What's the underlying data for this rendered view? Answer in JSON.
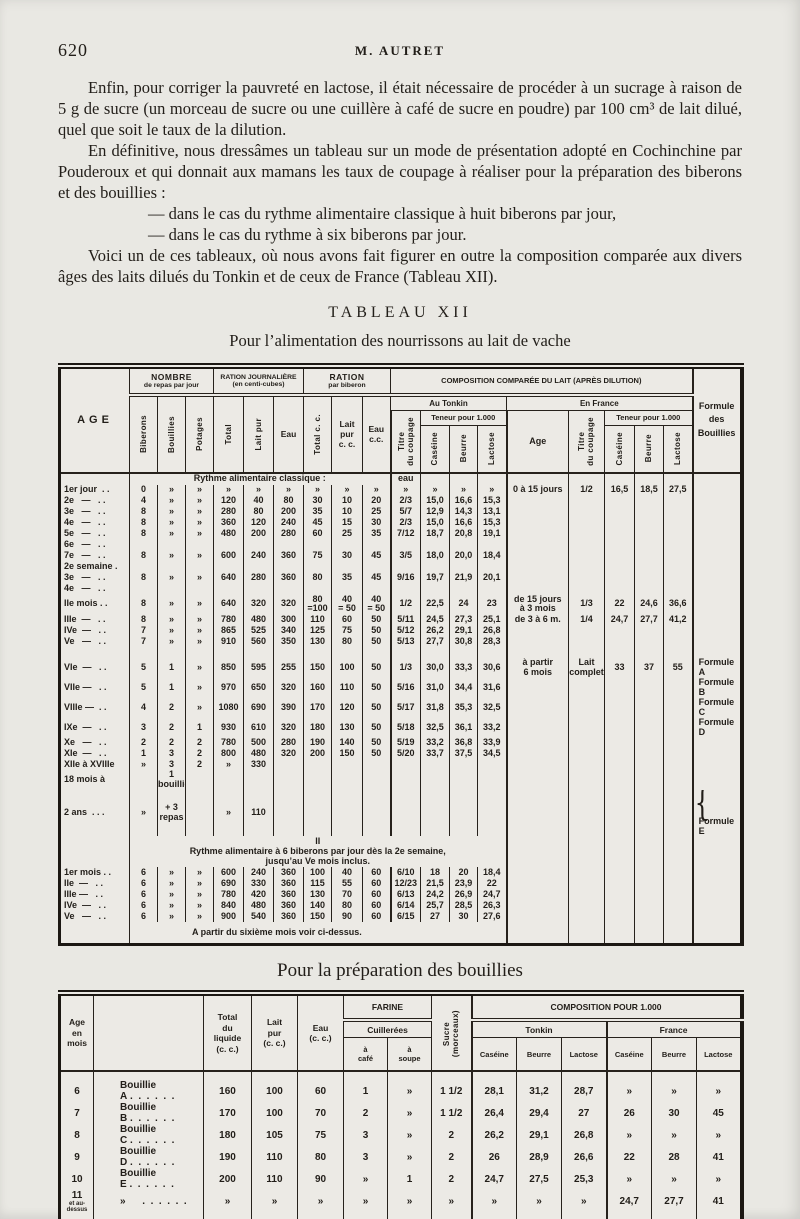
{
  "page": {
    "number": "620",
    "running_title": "M. AUTRET",
    "para1": "Enfin, pour corriger la pauvreté en lactose, il était nécessaire de procéder à un sucrage à raison de 5 g de sucre (un morceau de sucre ou une cuillère à café de sucre en poudre) par 100 cm³ de lait dilué, quel que soit le taux de la dilution.",
    "para2": "En définitive, nous dressâmes un tableau sur un mode de présentation adopté en Cochinchine par Pouderoux et qui donnait aux mamans les taux de coupage à réaliser pour la préparation des biberons et des bouillies :",
    "bullet1": "— dans le cas du rythme alimentaire classique à huit biberons par jour,",
    "bullet2": "— dans le cas du rythme à six biberons par jour.",
    "para3": "Voici un de ces tableaux, où nous avons fait figurer en outre la composition comparée aux divers âges des laits dilués du Tonkin et de ceux de France (Tableau XII).",
    "table1_title": "TABLEAU XII",
    "table1_subtitle": "Pour l’alimentation des nourrissons au lait de vache",
    "table2_title": "Pour la préparation des bouillies"
  },
  "table1": {
    "header": {
      "age": "AGE",
      "nombre": "NOMBRE",
      "nombre_sub": "de repas par jour",
      "ration_j": "RATION JOURNALIÈRE",
      "ration_j_sub": "(en centi-cubes)",
      "ration_b": "RATION",
      "ration_b_sub": "par biberon",
      "composition": "COMPOSITION COMPARÉE DU LAIT (APRÈS DILUTION)",
      "tonkin": "Au Tonkin",
      "france": "En France",
      "teneur": "Teneur pour 1.000",
      "formule": "Formule\ndes\nBouillies",
      "cols": {
        "biberons": "Biberons",
        "bouillies": "Bouillies",
        "potages": "Potages",
        "total": "Total",
        "lait_pur": "Lait pur",
        "eau": "Eau",
        "total_cc": "Total c. c.",
        "lait_cc": "Lait\npur\nc. c.",
        "eau_cc": "Eau\nc.c.",
        "titre": "Titre\ndu coupage",
        "caseine": "Caséine",
        "beurre": "Beurre",
        "lactose": "Lactose",
        "age_fr": "Age"
      }
    },
    "brace_glyph": "{",
    "section1": {
      "heading": "Rythme alimentaire classique :",
      "eau_note": "eau",
      "rows": [
        {
          "age": "1er jour  . .",
          "c": [
            "0",
            "»",
            "»",
            "»",
            "»",
            "»",
            "»",
            "»",
            "»",
            "»",
            "»",
            "»",
            "»"
          ],
          "fr": [
            "0 à 15 jours",
            "1/2",
            "16,5",
            "18,5",
            "27,5"
          ]
        },
        {
          "age": "2e   —   . .",
          "c": [
            "4",
            "»",
            "»",
            "120",
            "40",
            "80",
            "30",
            "10",
            "20",
            "2/3",
            "15,0",
            "16,6",
            "15,3"
          ]
        },
        {
          "age": "3e   —   . .",
          "c": [
            "8",
            "»",
            "»",
            "280",
            "80",
            "200",
            "35",
            "10",
            "25",
            "5/7",
            "12,9",
            "14,3",
            "13,1"
          ]
        },
        {
          "age": "4e   —   . .",
          "c": [
            "8",
            "»",
            "»",
            "360",
            "120",
            "240",
            "45",
            "15",
            "30",
            "2/3",
            "15,0",
            "16,6",
            "15,3"
          ]
        },
        {
          "age": "5e   —   . .",
          "c": [
            "8",
            "»",
            "»",
            "480",
            "200",
            "280",
            "60",
            "25",
            "35",
            "7/12",
            "18,7",
            "20,8",
            "19,1"
          ]
        },
        {
          "age": "6e   —   . ."
        },
        {
          "age": "7e   —   . .",
          "c": [
            "8",
            "»",
            "»",
            "600",
            "240",
            "360",
            "75",
            "30",
            "45",
            "3/5",
            "18,0",
            "20,0",
            "18,4"
          ]
        },
        {
          "age": "2e semaine ."
        },
        {
          "age": "3e   —   . .",
          "c": [
            "8",
            "»",
            "»",
            "640",
            "280",
            "360",
            "80",
            "35",
            "45",
            "9/16",
            "19,7",
            "21,9",
            "20,1"
          ]
        },
        {
          "age": "4e   —   . ."
        },
        {
          "age": "IIe mois . .",
          "c": [
            "8",
            "»",
            "»",
            "640",
            "320",
            "320",
            "80\n=100",
            "40\n= 50",
            "40\n= 50",
            "1/2",
            "22,5",
            "24",
            "23"
          ],
          "fr": [
            "de 15 jours\nà 3 mois",
            "1/3",
            "22",
            "24,6",
            "36,6"
          ]
        },
        {
          "age": "IIIe  —   . .",
          "c": [
            "8",
            "»",
            "»",
            "780",
            "480",
            "300",
            "110",
            "60",
            "50",
            "5/11",
            "24,5",
            "27,3",
            "25,1"
          ],
          "fr": [
            "de 3 à 6 m.",
            "1/4",
            "24,7",
            "27,7",
            "41,2"
          ]
        },
        {
          "age": "IVe  —   . .",
          "c": [
            "7",
            "»",
            "»",
            "865",
            "525",
            "340",
            "125",
            "75",
            "50",
            "5/12",
            "26,2",
            "29,1",
            "26,8"
          ]
        },
        {
          "age": "Ve   —   . .",
          "c": [
            "7",
            "»",
            "»",
            "910",
            "560",
            "350",
            "130",
            "80",
            "50",
            "5/13",
            "27,7",
            "30,8",
            "28,3"
          ]
        },
        {
          "spacer": true
        },
        {
          "age": "VIe  —   . .",
          "c": [
            "5",
            "1",
            "»",
            "850",
            "595",
            "255",
            "150",
            "100",
            "50",
            "1/3",
            "30,0",
            "33,3",
            "30,6"
          ],
          "fr": [
            "à partir\n6 mois",
            "Lait\ncomplet",
            "33",
            "37",
            "55"
          ],
          "f": "Formule A"
        },
        {
          "age": "VIIe —   . .",
          "c": [
            "5",
            "1",
            "»",
            "970",
            "650",
            "320",
            "160",
            "110",
            "50",
            "5/16",
            "31,0",
            "34,4",
            "31,6"
          ],
          "f": "Formule B"
        },
        {
          "age": "VIIIe —  . .",
          "c": [
            "4",
            "2",
            "»",
            "1080",
            "690",
            "390",
            "170",
            "120",
            "50",
            "5/17",
            "31,8",
            "35,3",
            "32,5"
          ],
          "f": "Formule C"
        },
        {
          "age": "IXe  —   . .",
          "c": [
            "3",
            "2",
            "1",
            "930",
            "610",
            "320",
            "180",
            "130",
            "50",
            "5/18",
            "32,5",
            "36,1",
            "33,2"
          ],
          "f": "Formule D"
        },
        {
          "age": "Xe   —   . .",
          "c": [
            "2",
            "2",
            "2",
            "780",
            "500",
            "280",
            "190",
            "140",
            "50",
            "5/19",
            "33,2",
            "36,8",
            "33,9"
          ]
        },
        {
          "age": "XIe  —   . .",
          "c": [
            "1",
            "3",
            "2",
            "800",
            "480",
            "320",
            "200",
            "150",
            "50",
            "5/20",
            "33,7",
            "37,5",
            "34,5"
          ]
        },
        {
          "age": "XIIe à XVIIIe",
          "c": [
            "»",
            "3",
            "2",
            "»",
            "330",
            "",
            "",
            "",
            "",
            "",
            "",
            "",
            ""
          ]
        },
        {
          "age": "18 mois à",
          "c": [
            "",
            "1 bouillie",
            "",
            "",
            "",
            "",
            "",
            "",
            "",
            "",
            "",
            "",
            ""
          ]
        },
        {
          "age": "2 ans  . . .",
          "c": [
            "»",
            "+ 3 repas",
            "",
            "»",
            "110",
            "",
            "",
            "",
            "",
            "",
            "",
            "",
            ""
          ],
          "f": "Formule E",
          "brace": true
        }
      ]
    },
    "section2": {
      "label": "II",
      "heading_line1": "Rythme alimentaire à 6 biberons par jour dès la 2e semaine,",
      "heading_line2": "jusqu’au Ve mois inclus.",
      "rows": [
        {
          "age": "1er mois . .",
          "c": [
            "6",
            "»",
            "»",
            "600",
            "240",
            "360",
            "100",
            "40",
            "60",
            "6/10",
            "18",
            "20",
            "18,4"
          ]
        },
        {
          "age": "IIe  —   . .",
          "c": [
            "6",
            "»",
            "»",
            "690",
            "330",
            "360",
            "115",
            "55",
            "60",
            "12/23",
            "21,5",
            "23,9",
            "22"
          ]
        },
        {
          "age": "IIIe —   . .",
          "c": [
            "6",
            "»",
            "»",
            "780",
            "420",
            "360",
            "130",
            "70",
            "60",
            "6/13",
            "24,2",
            "26,9",
            "24,7"
          ]
        },
        {
          "age": "IVe  —   . .",
          "c": [
            "6",
            "»",
            "»",
            "840",
            "480",
            "360",
            "140",
            "80",
            "60",
            "6/14",
            "25,7",
            "28,5",
            "26,3"
          ]
        },
        {
          "age": "Ve   —   . .",
          "c": [
            "6",
            "»",
            "»",
            "900",
            "540",
            "360",
            "150",
            "90",
            "60",
            "6/15",
            "27",
            "30",
            "27,6"
          ]
        }
      ],
      "footnote": "A partir du sixième mois voir ci-dessus."
    }
  },
  "table2": {
    "header": {
      "age": "Age\nen\nmois",
      "name": "",
      "total": "Total\ndu\nliquide\n(c. c.)",
      "lait": "Lait\npur\n(c. c.)",
      "eau": "Eau\n(c. c.)",
      "farine": "FARINE",
      "cuillerees": "Cuillerées",
      "cafe": "à\ncafé",
      "soupe": "à\nsoupe",
      "sucre": "Sucre\n(morceaux)",
      "composition": "COMPOSITION POUR 1.000",
      "tonkin": "Tonkin",
      "france": "France",
      "caseine": "Caséine",
      "beurre": "Beurre",
      "lactose": "Lactose"
    },
    "rows": [
      {
        "age": "6",
        "name": "Bouillie A",
        "dots": " .  .  .  .  .  .",
        "v": [
          "160",
          "100",
          "60",
          "1",
          "»",
          "1 1/2",
          "28,1",
          "31,2",
          "28,7",
          "»",
          "»",
          "»"
        ]
      },
      {
        "age": "7",
        "name": "Bouillie B",
        "dots": " .  .  .  .  .  .",
        "v": [
          "170",
          "100",
          "70",
          "2",
          "»",
          "1 1/2",
          "26,4",
          "29,4",
          "27",
          "26",
          "30",
          "45"
        ]
      },
      {
        "age": "8",
        "name": "Bouillie C",
        "dots": " .  .  .  .  .  .",
        "v": [
          "180",
          "105",
          "75",
          "3",
          "»",
          "2",
          "26,2",
          "29,1",
          "26,8",
          "»",
          "»",
          "»"
        ]
      },
      {
        "age": "9",
        "name": "Bouillie D",
        "dots": " .  .  .  .  .  .",
        "v": [
          "190",
          "110",
          "80",
          "3",
          "»",
          "2",
          "26",
          "28,9",
          "26,6",
          "22",
          "28",
          "41"
        ]
      },
      {
        "age": "10",
        "name": "Bouillie E",
        "dots": " .  .  .  .  .  .",
        "v": [
          "200",
          "110",
          "90",
          "»",
          "1",
          "2",
          "24,7",
          "27,5",
          "25,3",
          "»",
          "»",
          "»"
        ]
      },
      {
        "age": "11",
        "age_sub": "et au-dessus",
        "name": "»",
        "dots": "      .  .  .  .  .  .",
        "v": [
          "»",
          "»",
          "»",
          "»",
          "»",
          "»",
          "»",
          "»",
          "»",
          "24,7",
          "27,7",
          "41"
        ]
      }
    ]
  }
}
